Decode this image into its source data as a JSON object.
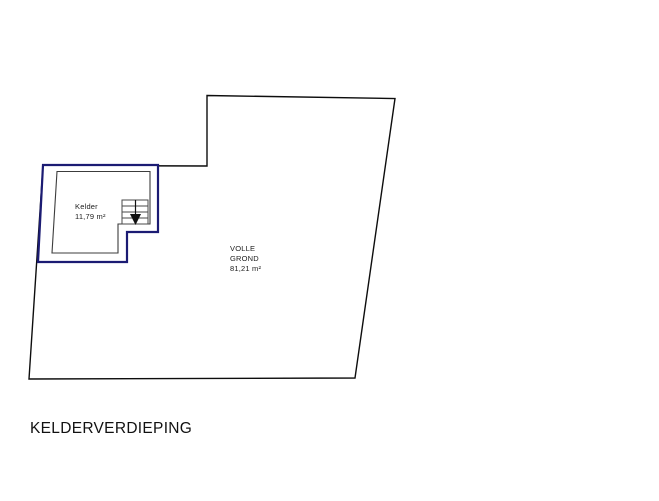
{
  "title": "KELDERVERDIEPING",
  "colors": {
    "basement_outline": "#1b1b73",
    "plan_line": "#0d0d0d"
  },
  "plan": {
    "kelder": {
      "name": "Kelder",
      "area": "11,79 m²"
    },
    "volle_grond": {
      "name_line1": "VOLLE",
      "name_line2": "GROND",
      "area": "81,21 m²"
    },
    "stairs": {
      "icon": "stairs-down-arrow",
      "direction": "down"
    }
  }
}
